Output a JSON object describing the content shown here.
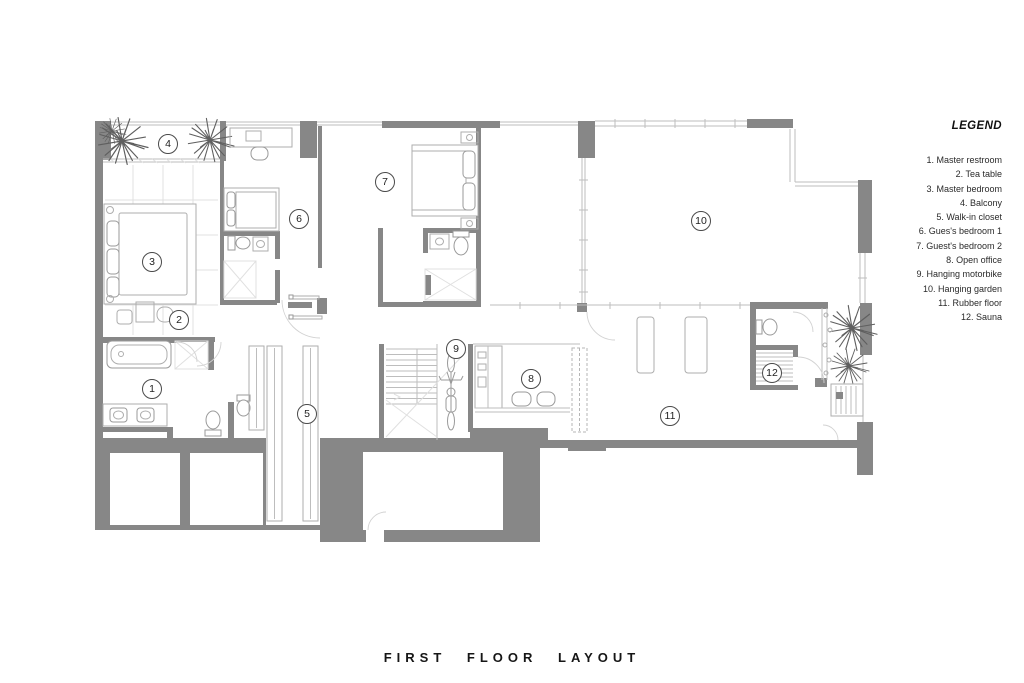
{
  "title": "FIRST FLOOR LAYOUT",
  "legend": {
    "heading": "LEGEND",
    "items": [
      "1. Master restroom",
      "2. Tea table",
      "3. Master bedroom",
      "4. Balcony",
      "5. Walk-in closet",
      "6. Gues's bedroom 1",
      "7. Guest's bedroom 2",
      "8. Open office",
      "9. Hanging motorbike",
      "10. Hanging garden",
      "11. Rubber floor",
      "12. Sauna"
    ]
  },
  "markers": [
    {
      "n": "1",
      "label": "Master restroom"
    },
    {
      "n": "2",
      "label": "Tea table"
    },
    {
      "n": "3",
      "label": "Master bedroom"
    },
    {
      "n": "4",
      "label": "Balcony"
    },
    {
      "n": "5",
      "label": "Walk-in closet"
    },
    {
      "n": "6",
      "label": "Gues's bedroom 1"
    },
    {
      "n": "7",
      "label": "Guest's bedroom 2"
    },
    {
      "n": "8",
      "label": "Open office"
    },
    {
      "n": "9",
      "label": "Hanging motorbike"
    },
    {
      "n": "10",
      "label": "Hanging garden"
    },
    {
      "n": "11",
      "label": "Rubber floor"
    },
    {
      "n": "12",
      "label": "Sauna"
    }
  ],
  "colors": {
    "wall": "#878787",
    "furniture_line": "#aeaeae",
    "faint_line": "#e0e0e0",
    "plant": "#5f5f5f",
    "text": "#222222"
  }
}
